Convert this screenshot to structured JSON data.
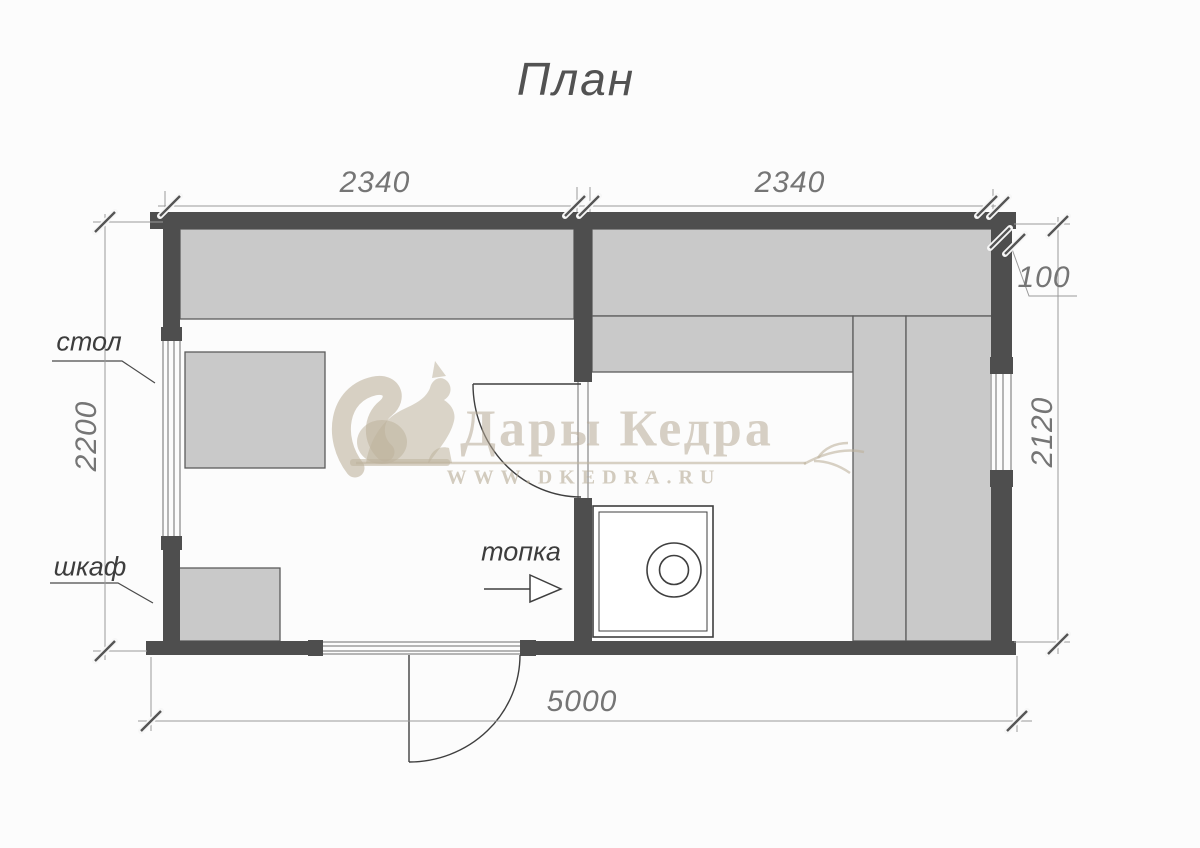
{
  "title": "План",
  "watermark": {
    "brand": "Дары Кедра",
    "url": "WWW.DKEDRA.RU"
  },
  "dimensions": {
    "left_room_width": "2340",
    "right_room_width": "2340",
    "wall_thickness": "100",
    "left_side_depth": "2200",
    "right_side_depth": "2120",
    "total_length": "5000"
  },
  "labels": {
    "table": "стол",
    "cabinet": "шкаф",
    "firebox": "топка"
  },
  "colors": {
    "wall": "#4e4e4e",
    "furniture_fill": "#c9c9c9",
    "dimension_line": "#9a9a9a",
    "annotation_text": "#757575",
    "watermark": "#beb29d"
  }
}
